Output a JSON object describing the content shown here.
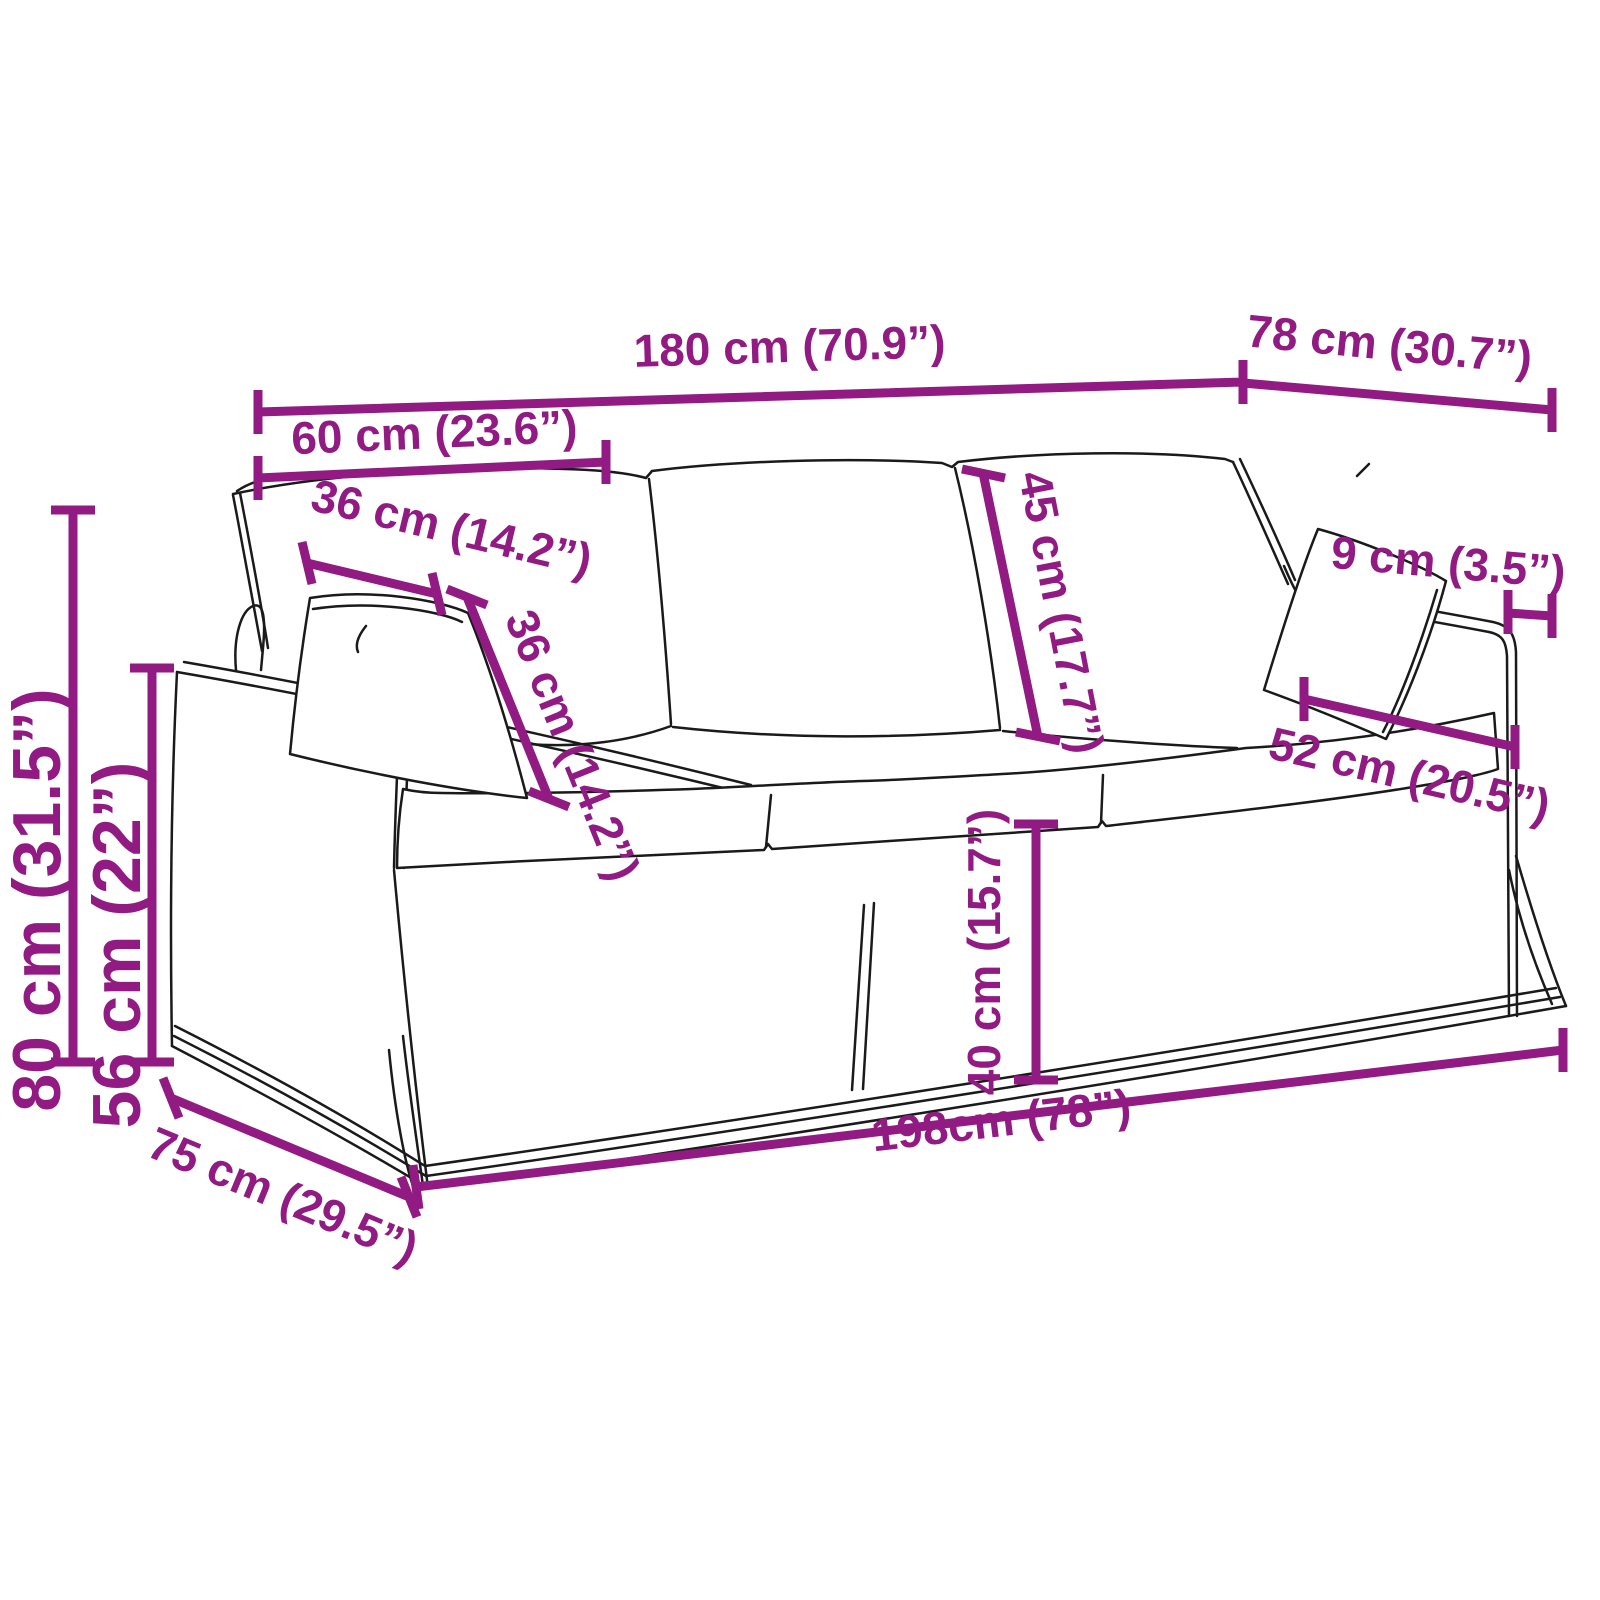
{
  "colors": {
    "dimension_accent": "#911B82",
    "drawing_line": "#1a1a1a",
    "background": "#ffffff"
  },
  "labels": {
    "width_180": "180 cm (70.9”)",
    "depth_78": "78 cm (30.7”)",
    "seat_width_60": "60 cm (23.6”)",
    "pillow_width_36": "36 cm (14.2”)",
    "pillow_height_36": "36 cm (14.2”)",
    "back_cushion_45": "45 cm (17.7”)",
    "armrest_top_9": "9 cm (3.5”)",
    "right_pillow_52": "52 cm (20.5”)",
    "total_height_80": "80 cm (31.5”)",
    "arm_height_56": "56 cm (22”)",
    "seat_height_40": "40 cm (15.7”)",
    "depth_75": "75 cm (29.5”)",
    "base_width_198": "198cm (78”)"
  }
}
